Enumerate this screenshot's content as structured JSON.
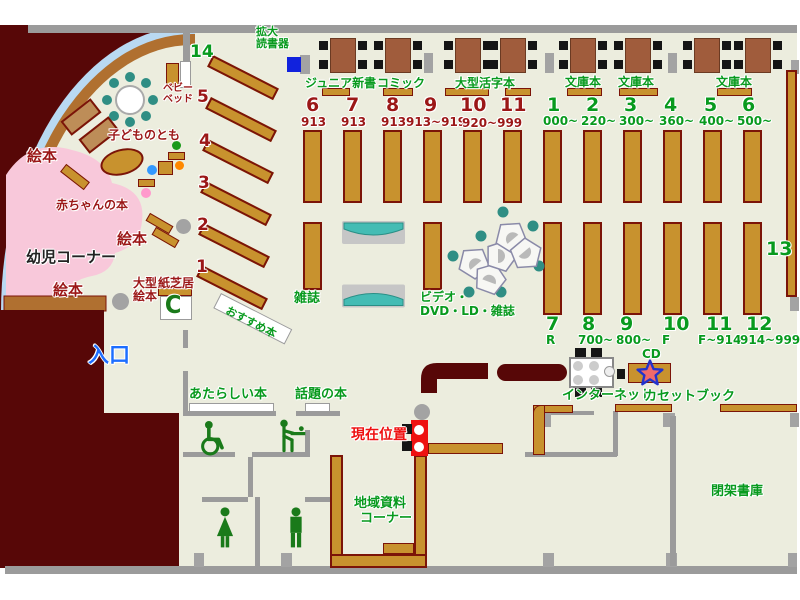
{
  "map_title": "library-floor-map",
  "colors": {
    "floor": "#ecedde",
    "outside": "#570707",
    "shelf": "#c8922e",
    "accent_green": "#089a1e",
    "accent_darkred": "#9b1717",
    "current_location_red": "#ee1111",
    "entrance_blue": "#1d6eff",
    "pink_area": "#f8c8da",
    "teal": "#44bcb4"
  },
  "children_corner": {
    "area_label": "幼児コーナー",
    "picture_books_1": "絵本",
    "picture_books_2": "絵本",
    "picture_books_3": "絵本",
    "baby_books": "赤ちゃんの本",
    "kodomonotomo": "子どものとも",
    "large_picture_l1": "大型",
    "large_picture_l2": "絵本",
    "kamishibai": "紙芝居",
    "baby_bed_l1": "ベビー",
    "baby_bed_l2": "ベッド"
  },
  "reading_device": {
    "l1": "拡大",
    "l2": "読書器"
  },
  "left_shelves": {
    "items": [
      {
        "num": "14",
        "range": "590~599"
      },
      {
        "num": "5",
        "range": "750~"
      },
      {
        "num": "4",
        "range": "490~"
      },
      {
        "num": "3",
        "range": "400~"
      },
      {
        "num": "2",
        "range": "280~"
      },
      {
        "num": "1",
        "range": "000~"
      }
    ],
    "recommend": "おすすめ本"
  },
  "top_sections": {
    "junior": "ジュニア新書",
    "comic": "コミック",
    "large_print": "大型活字本",
    "bunko_1": "文庫本",
    "bunko_2": "文庫本",
    "bunko_3": "文庫本",
    "red": [
      {
        "num": "6",
        "range": "913"
      },
      {
        "num": "7",
        "range": "913"
      },
      {
        "num": "8",
        "range": "913"
      },
      {
        "num": "9",
        "range": "913~919"
      },
      {
        "num": "10",
        "range": ""
      },
      {
        "num": "11",
        "range": ""
      }
    ],
    "red_shared_range": "920~999",
    "green": [
      {
        "num": "1",
        "range": "000~"
      },
      {
        "num": "2",
        "range": "220~"
      },
      {
        "num": "3",
        "range": "300~"
      },
      {
        "num": "4",
        "range": "360~"
      },
      {
        "num": "5",
        "range": "400~"
      },
      {
        "num": "6",
        "range": "500~"
      }
    ]
  },
  "bottom_sections": [
    {
      "num": "7",
      "range": "R"
    },
    {
      "num": "8",
      "range": "700~"
    },
    {
      "num": "9",
      "range": "800~"
    },
    {
      "num": "10",
      "range": "F"
    },
    {
      "num": "11",
      "range": "F~914"
    },
    {
      "num": "12",
      "range": "914~999"
    }
  ],
  "section13": "13",
  "center": {
    "magazines": "雑誌",
    "video_l1": "ビデオ・",
    "video_l2": "DVD・LD・雑誌"
  },
  "south": {
    "entrance": "入口",
    "new_books": "あたらしい本",
    "topic_books": "話題の本",
    "current_location": "現在位置",
    "internet": "インターネット",
    "cd": "CD",
    "cassette": "カセットブック",
    "local_l1": "地域資料",
    "local_l2": "コーナー",
    "closed_stacks": "閉架書庫",
    "phone_glyph": "C"
  }
}
